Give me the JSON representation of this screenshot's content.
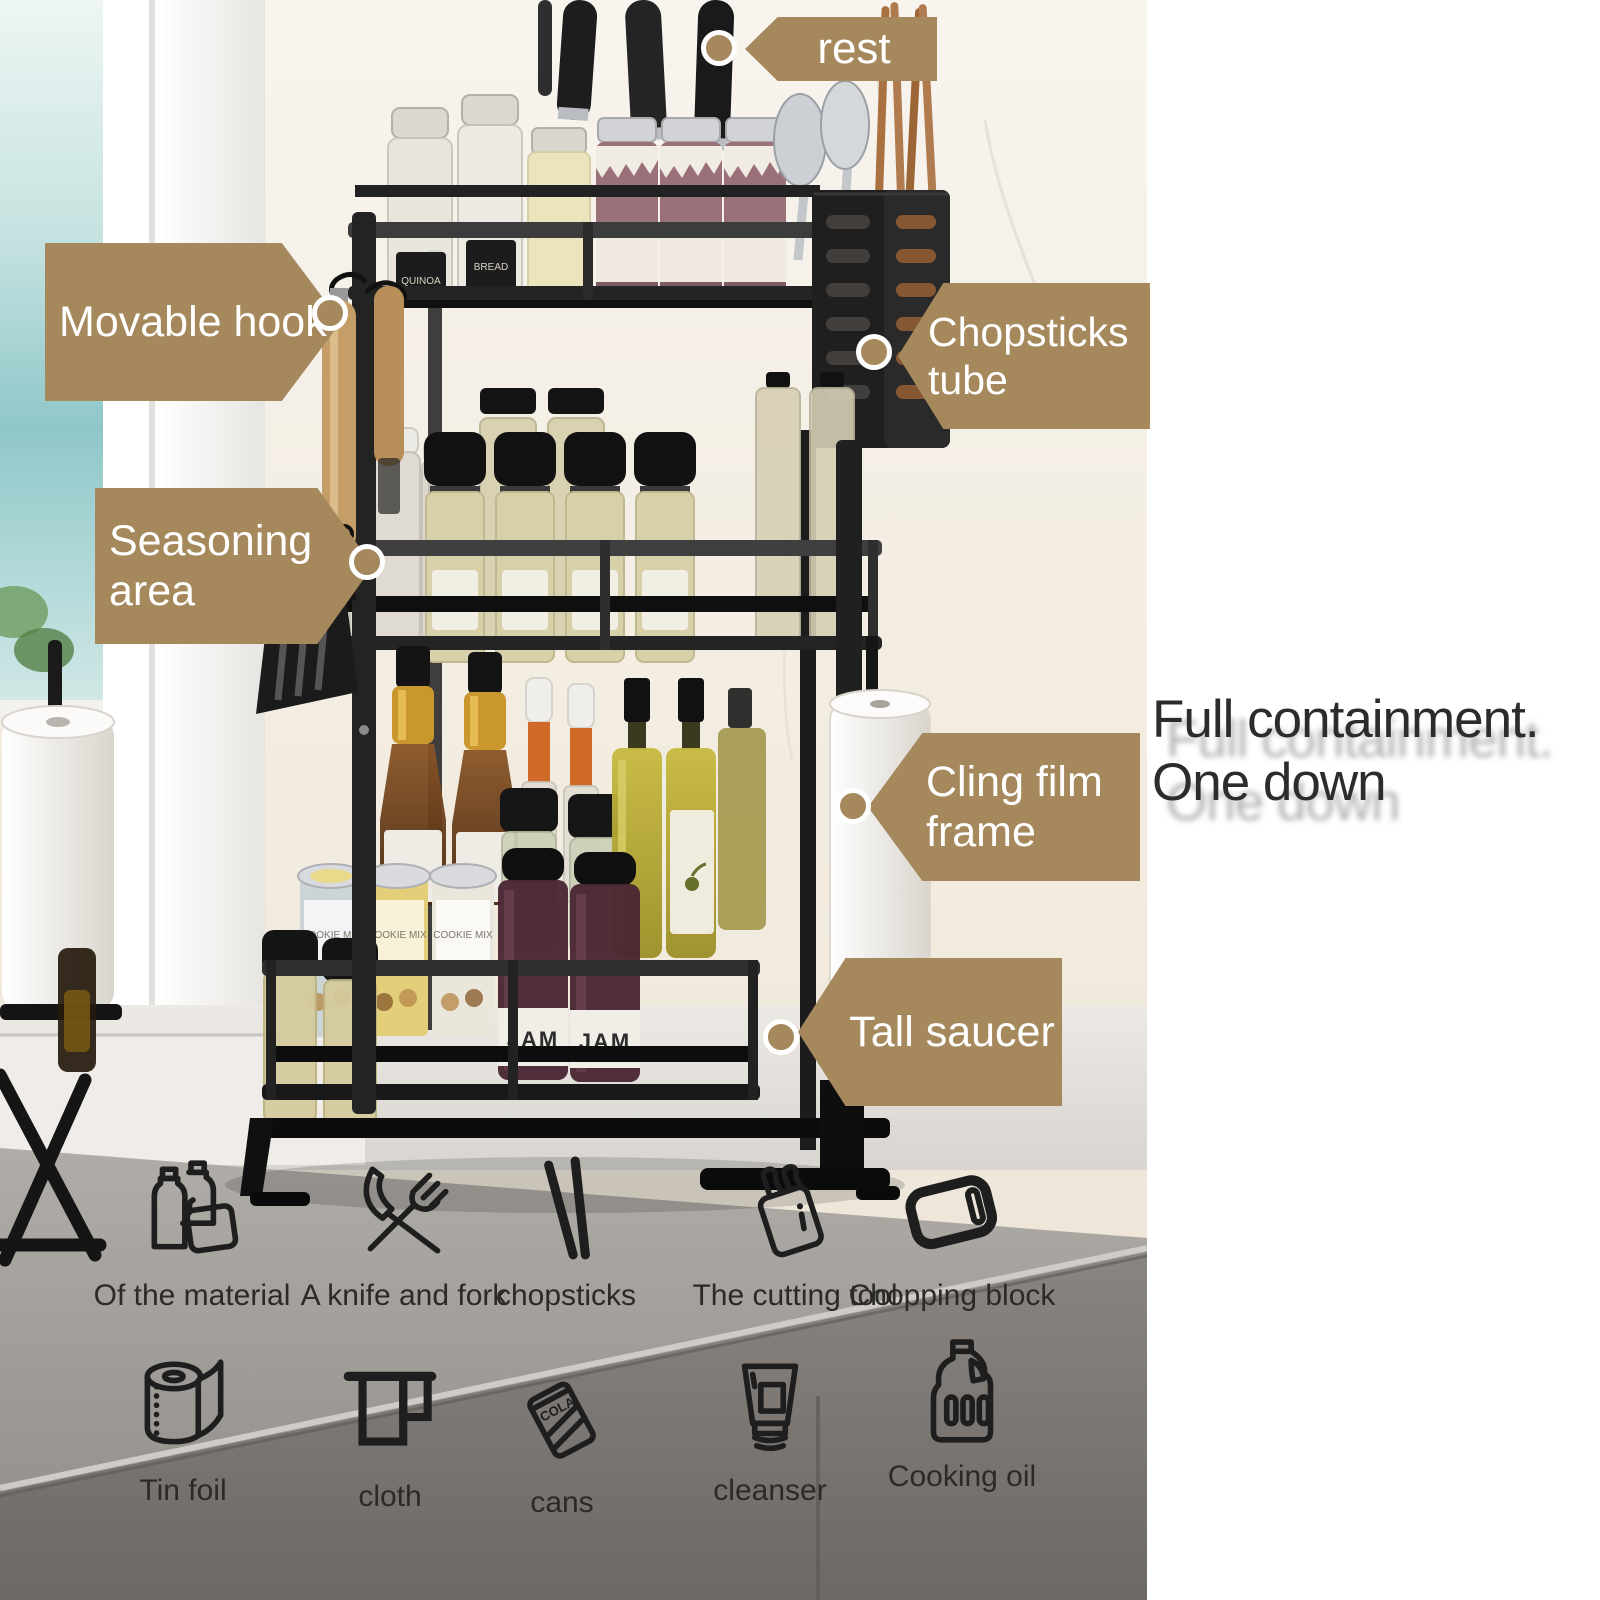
{
  "callouts": {
    "rest": "rest",
    "movable_hook": "Movable hook",
    "chopsticks_tube": "Chopsticks tube",
    "seasoning_area": "Seasoning area",
    "cling_film_frame": "Cling film frame",
    "tall_saucer": "Tall saucer"
  },
  "headline": {
    "line1": "Full containment.",
    "line2": "One down"
  },
  "features": {
    "row1": [
      {
        "icon": "bottles-icon",
        "label": "Of the material"
      },
      {
        "icon": "knife-fork-icon",
        "label": "A knife and fork"
      },
      {
        "icon": "chopsticks-icon",
        "label": "chopsticks"
      },
      {
        "icon": "knife-block-icon",
        "label": "The cutting tool"
      },
      {
        "icon": "chopping-block-icon",
        "label": "Chopping block"
      }
    ],
    "row2": [
      {
        "icon": "paper-roll-icon",
        "label": "Tin foil"
      },
      {
        "icon": "cloth-icon",
        "label": "cloth"
      },
      {
        "icon": "can-icon",
        "label": "cans"
      },
      {
        "icon": "cleanser-icon",
        "label": "cleanser"
      },
      {
        "icon": "oil-jug-icon",
        "label": "Cooking oil"
      }
    ]
  },
  "scene": {
    "texts": {
      "quinoa": "QUINOA",
      "bread": "BREAD",
      "cookie_mix": "COOKIE MIX",
      "jam": "JAM",
      "cola": "COLA"
    }
  },
  "colors": {
    "callout_bg": "#a5885c",
    "callout_text": "#ffffff",
    "headline_text": "#2d2c2a",
    "feature_label_text": "#2b2a28",
    "icon_stroke": "#1e1e1e",
    "rack_black": "#1a1a1a",
    "counter_gray": "#8e8a85",
    "window_teal": "#8fc7c9"
  }
}
